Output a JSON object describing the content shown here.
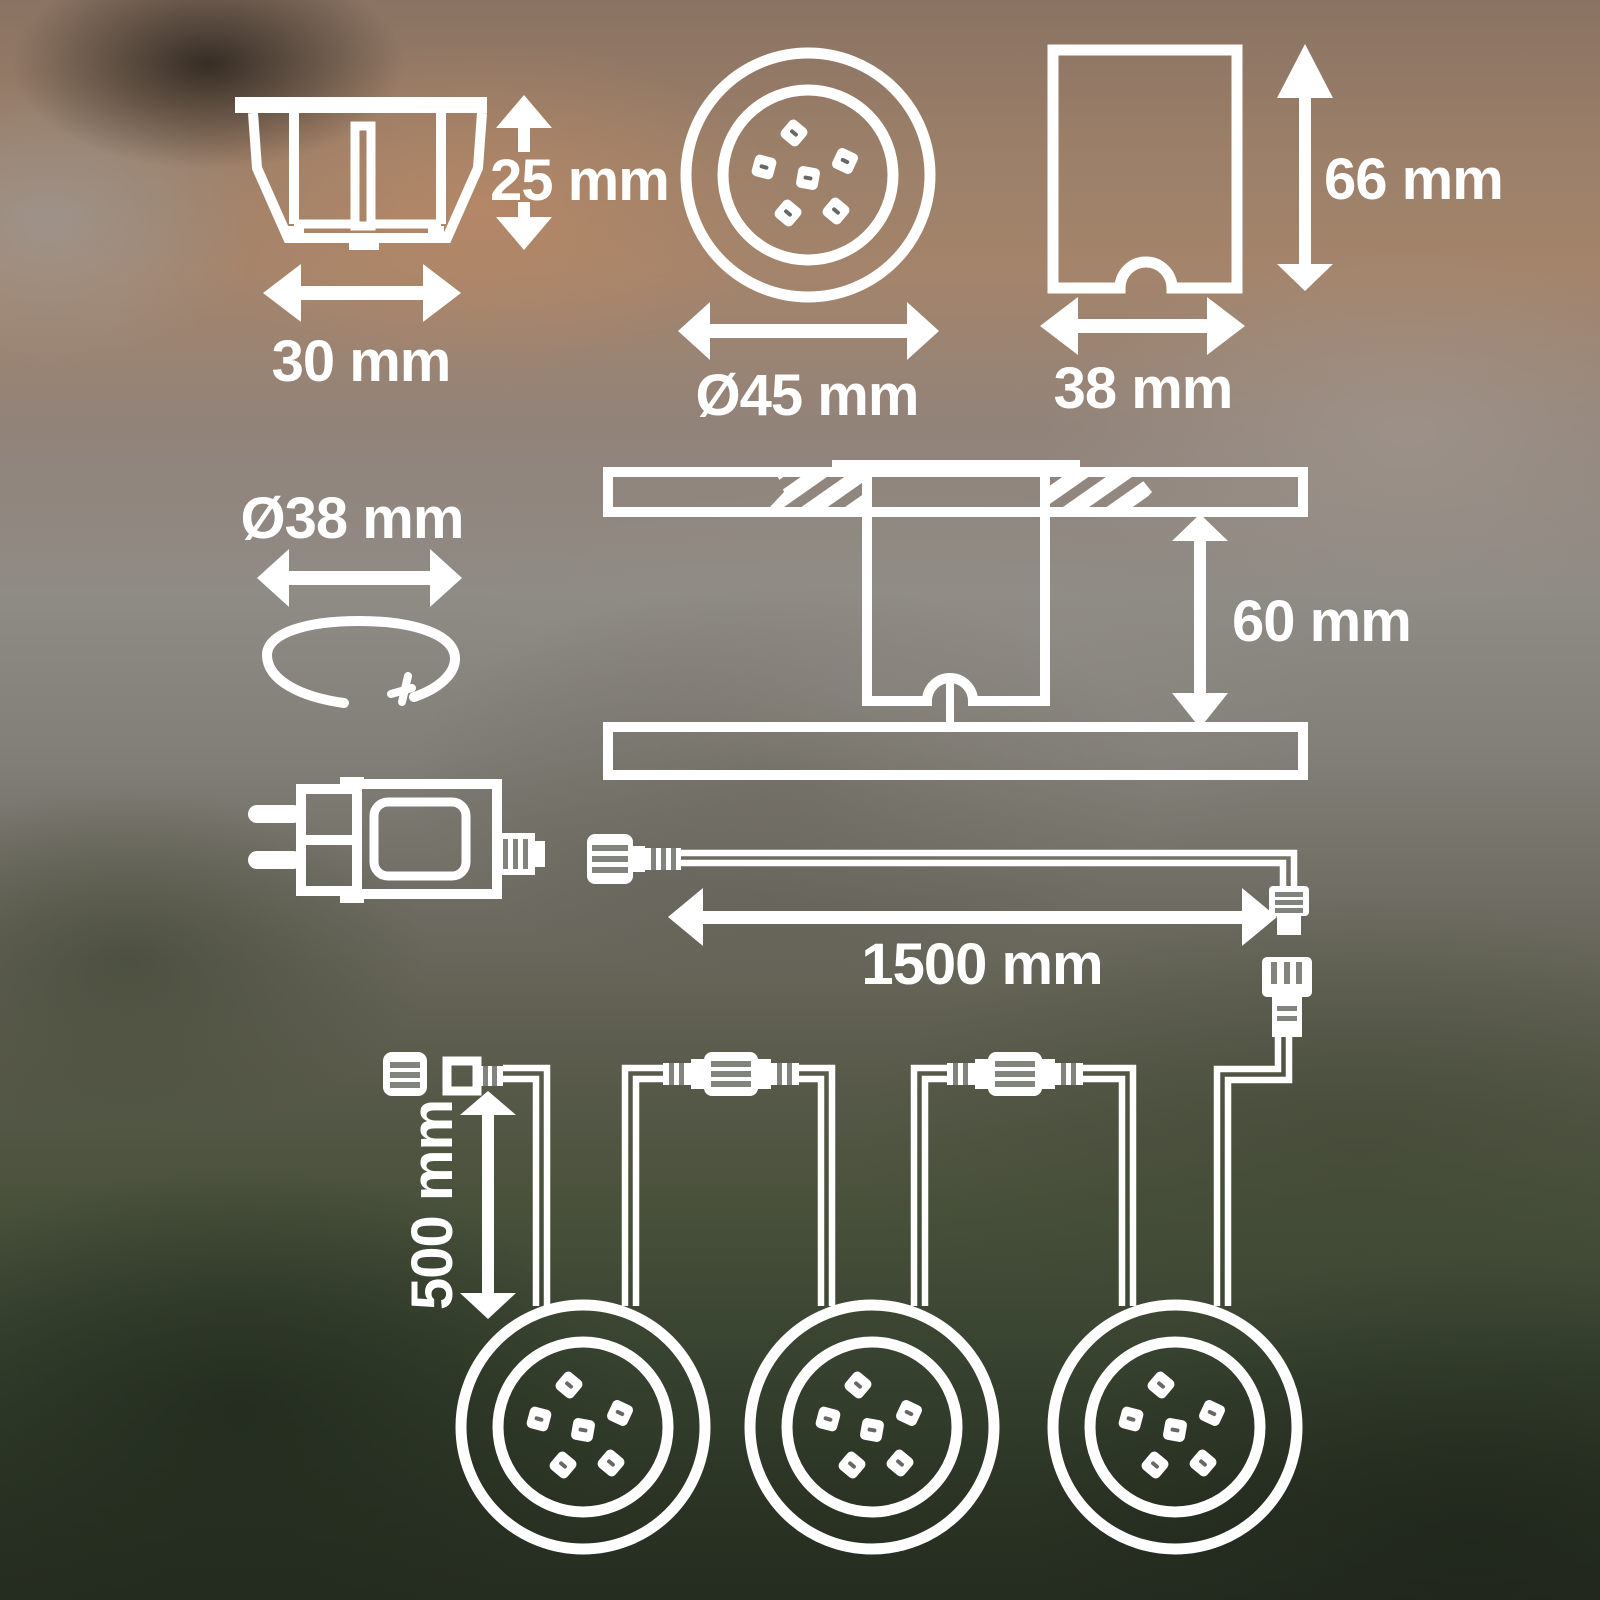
{
  "diagram": {
    "line_color": "#ffffff",
    "housing_side_view": {
      "height_label": "25 mm",
      "width_label": "30 mm"
    },
    "light_top_view": {
      "diameter_label": "Ø45 mm",
      "led_count": 6
    },
    "sleeve_side_view": {
      "height_label": "66 mm",
      "width_label": "38 mm"
    },
    "mounting_ring": {
      "diameter_label": "Ø38 mm"
    },
    "installation_section": {
      "recess_depth_label": "60 mm"
    },
    "supply_cable": {
      "length_label": "1500 mm"
    },
    "light_chain": {
      "cable_length_label": "500 mm",
      "light_count": 3
    }
  }
}
